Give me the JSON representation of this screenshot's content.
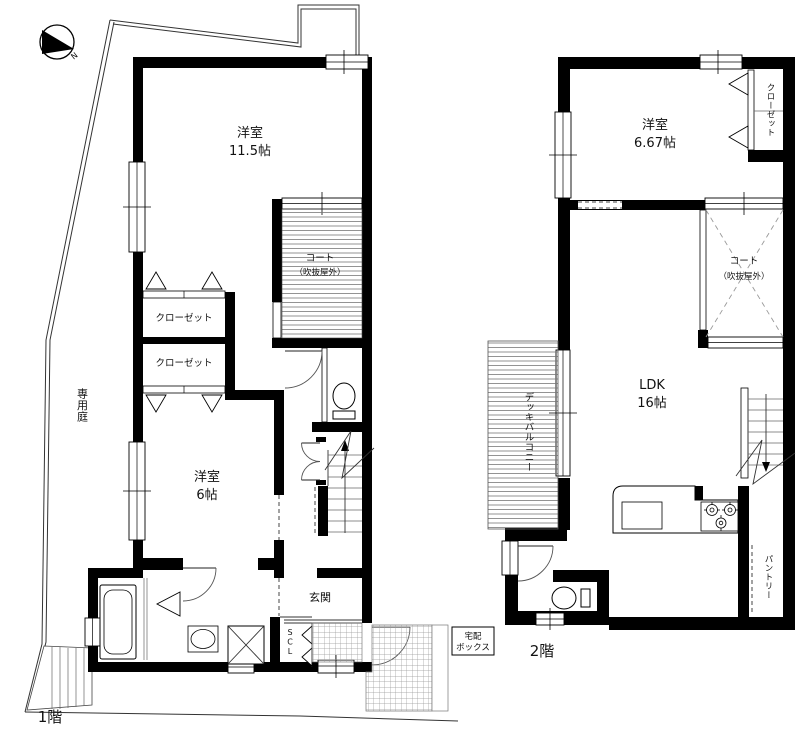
{
  "compass": {
    "north": "N"
  },
  "floor1": {
    "floor_label": "1階",
    "garden": "専用庭",
    "bedroom115": {
      "name": "洋室",
      "size": "11.5帖"
    },
    "court": {
      "name": "コート",
      "note": "（吹抜屋外）"
    },
    "closet_upper": "クローゼット",
    "closet_lower": "クローゼット",
    "bedroom6": {
      "name": "洋室",
      "size": "6帖"
    },
    "entrance": "玄関",
    "scl": "SCL",
    "delivery_box": {
      "line1": "宅配",
      "line2": "ボックス"
    }
  },
  "floor2": {
    "floor_label": "2階",
    "bedroom667": {
      "name": "洋室",
      "size": "6.67帖"
    },
    "closet": "クローゼット",
    "court": {
      "name": "コート",
      "note": "（吹抜屋外）"
    },
    "ldk": {
      "name": "LDK",
      "size": "16帖"
    },
    "deck_balcony": "デッキバルコニー",
    "pantry": "パントリー"
  },
  "colors": {
    "wall": "#000000",
    "background": "#ffffff",
    "hatch": "#777777"
  }
}
